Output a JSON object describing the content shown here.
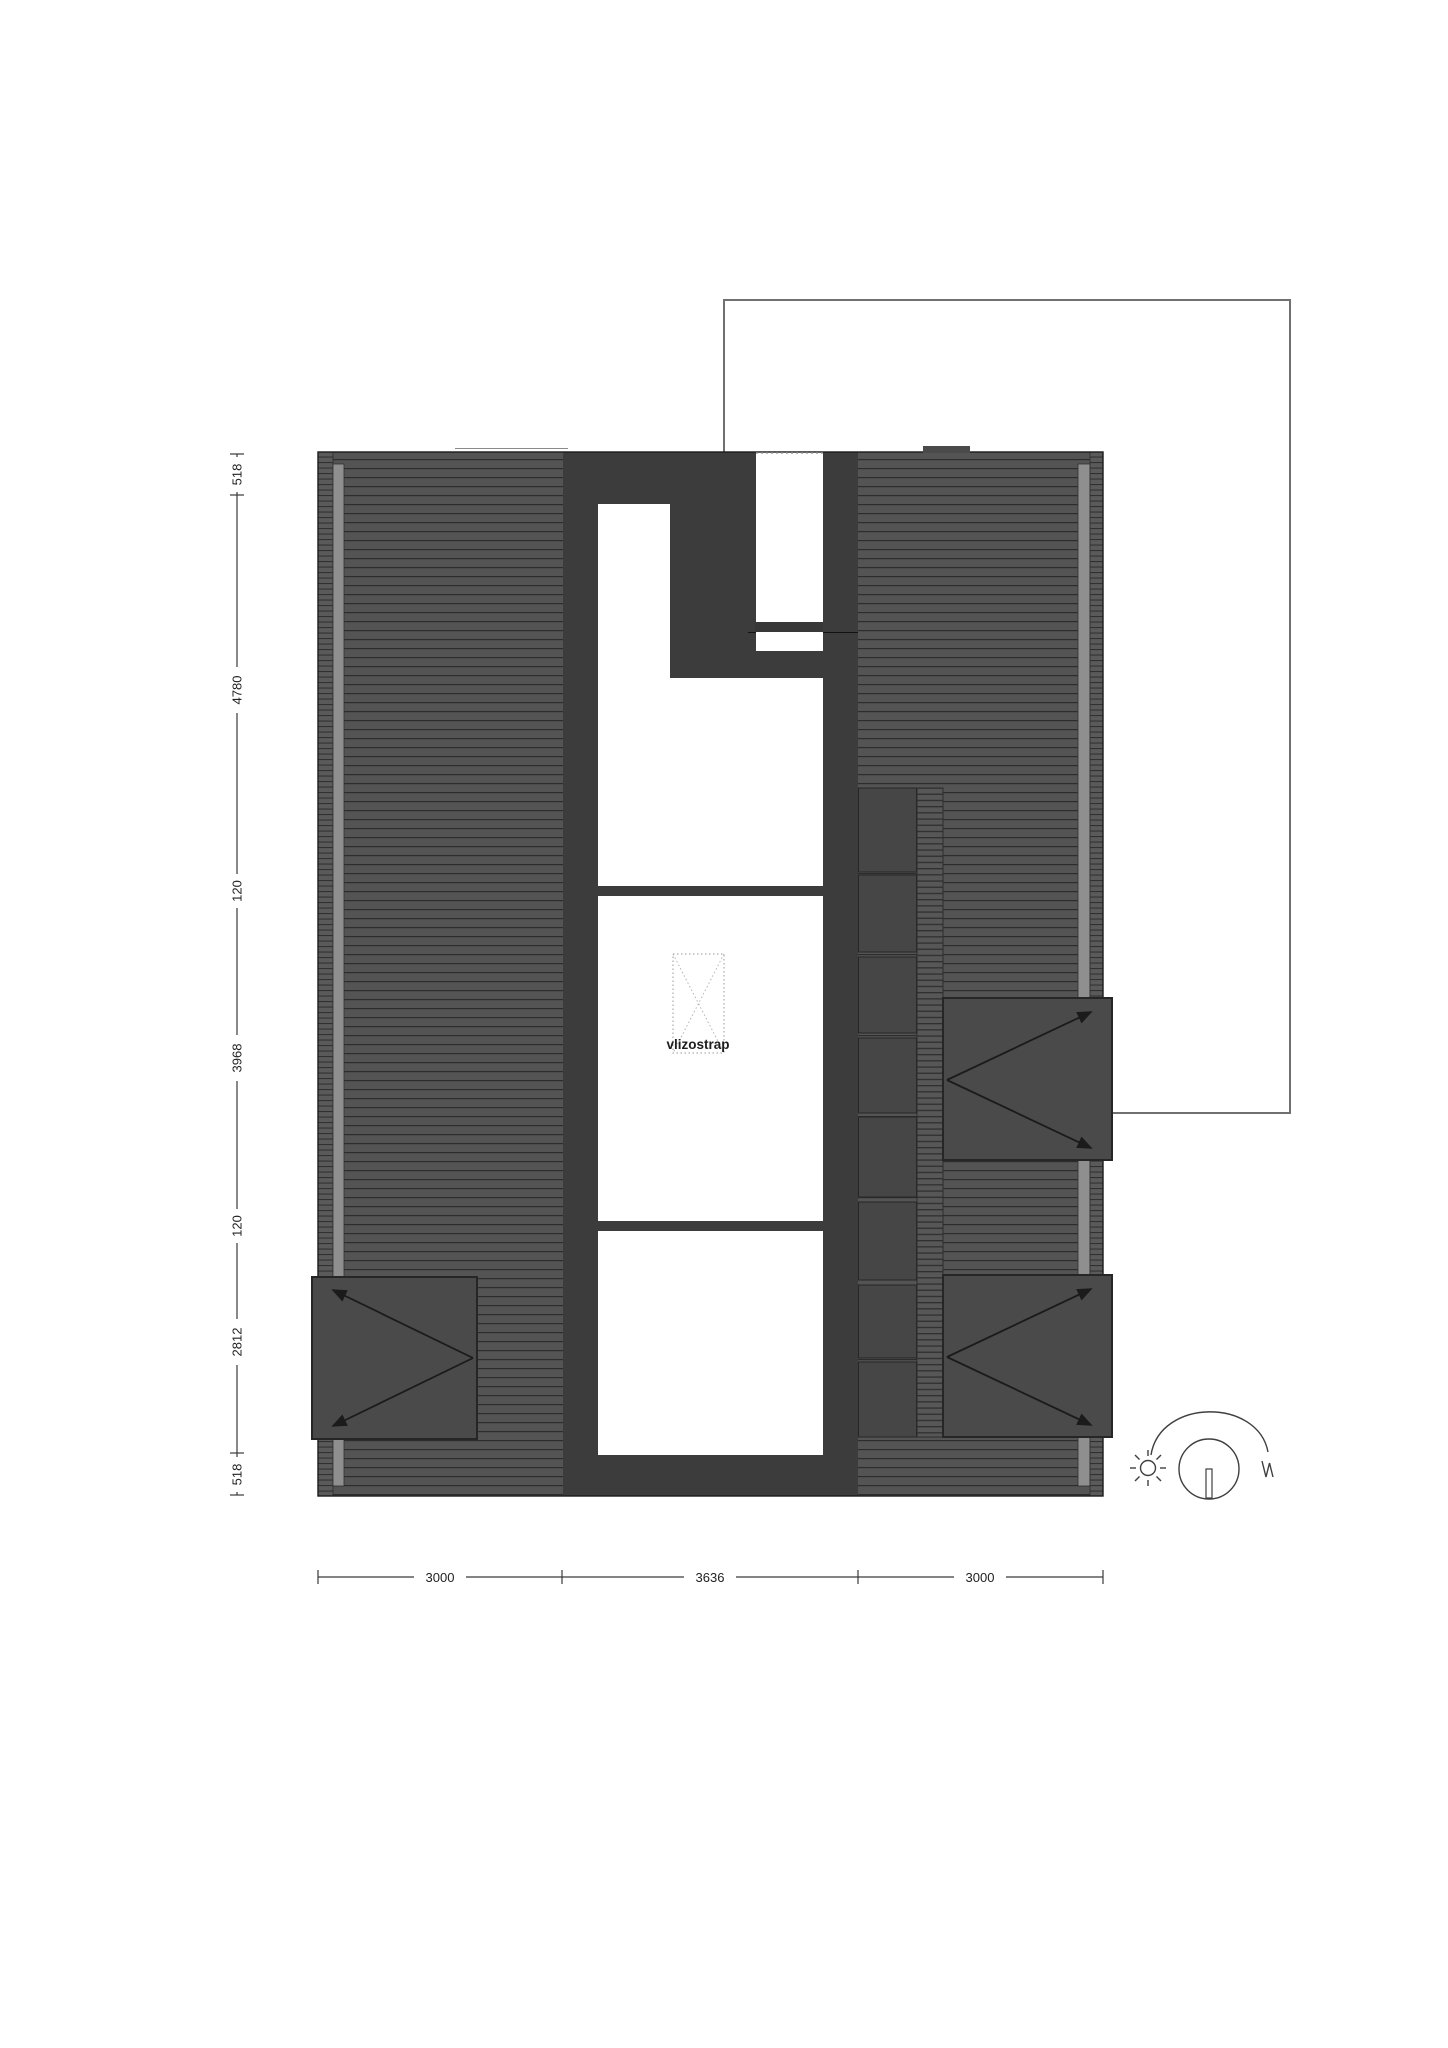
{
  "plan": {
    "loft_ladder_label": "vlizostrap",
    "dim_left": [
      "518",
      "4780",
      "120",
      "3968",
      "120",
      "2812",
      "518"
    ],
    "dim_bottom": [
      "3000",
      "3636",
      "3000"
    ],
    "dormer_count": 3,
    "chimney_block_count": 8,
    "colors": {
      "roof_field": "#545454",
      "hatch_line": "#2d2d2d",
      "wall": "#3c3c3c",
      "block": "#464646",
      "dormer": "#4a4a4a",
      "fascia": "#8f8f8f",
      "outline": "#1b1b1b",
      "courtyard_outline": "#707070",
      "dim_line": "#3a3a3a",
      "text": "#222222"
    }
  }
}
